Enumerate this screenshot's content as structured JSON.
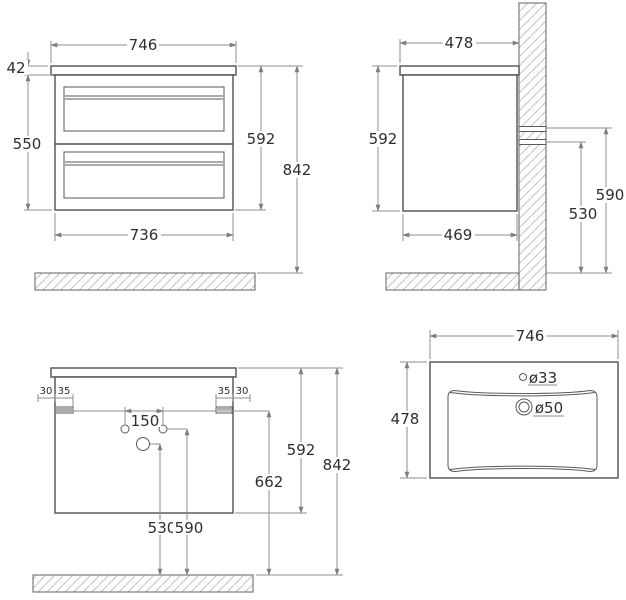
{
  "front_view": {
    "top_width": "746",
    "counter_thickness": "42",
    "body_height": "550",
    "cabinet_height": "592",
    "total_height": "842",
    "bottom_width": "736"
  },
  "side_view": {
    "top_depth": "478",
    "cabinet_height": "592",
    "bottom_depth": "469",
    "upper_mount_height": "590",
    "lower_mount_height": "530"
  },
  "back_view": {
    "left_outer_offset": "30",
    "left_bracket_width": "35",
    "hole_spacing": "150",
    "right_bracket_width": "35",
    "right_outer_offset": "30",
    "cabinet_height": "592",
    "mount_to_floor": "662",
    "total_height": "842",
    "drain_height": "530",
    "supply_height": "590"
  },
  "top_view": {
    "width": "746",
    "depth": "478",
    "faucet_hole": "ø33",
    "drain_hole": "ø50"
  }
}
